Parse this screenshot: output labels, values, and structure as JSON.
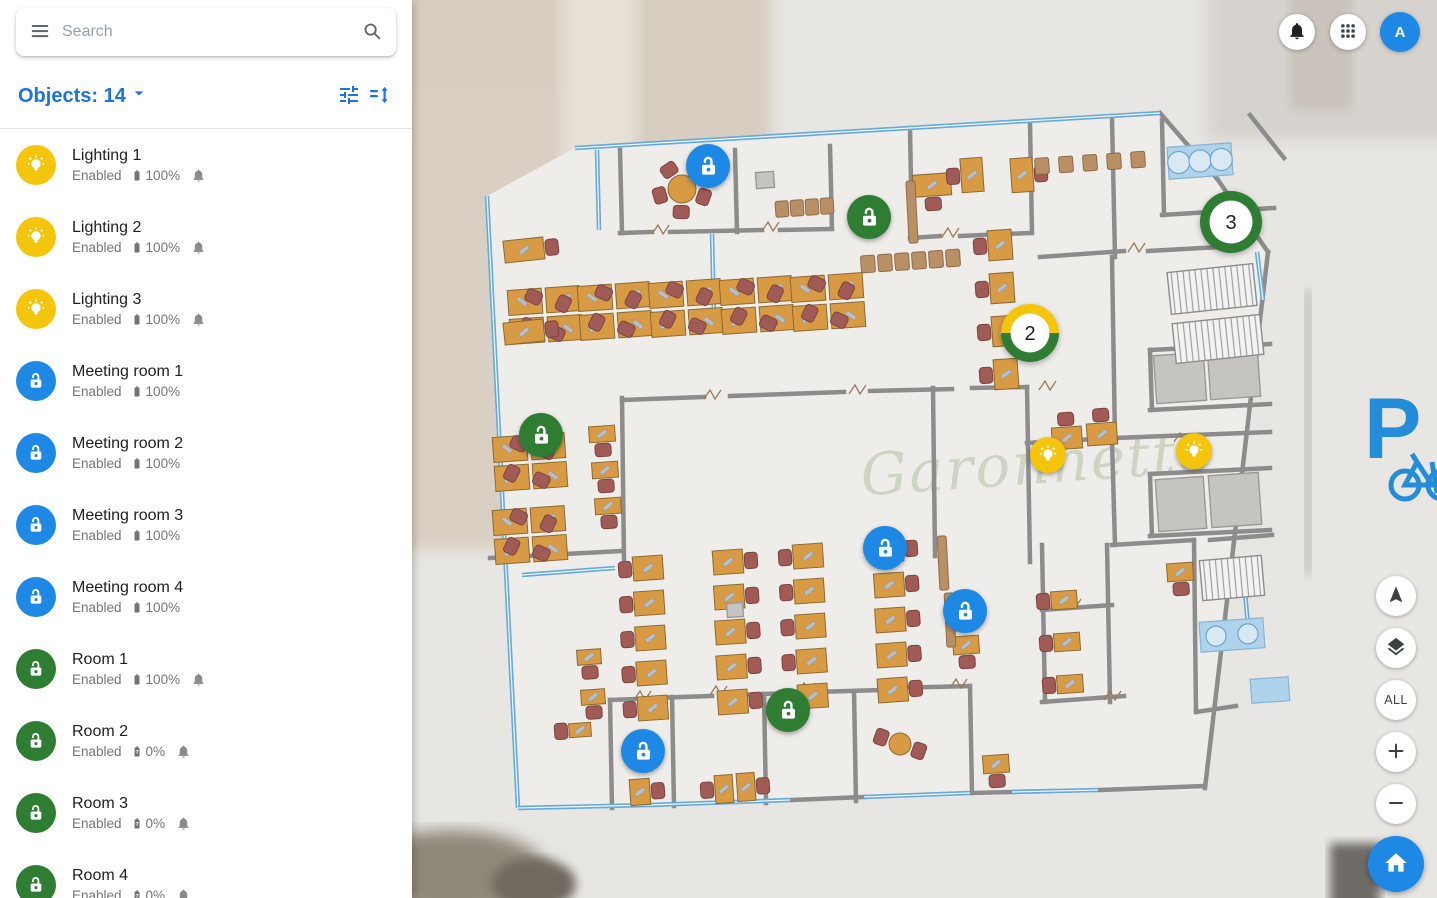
{
  "colors": {
    "accent_blue": "#1a73e8",
    "pin_blue": "#1E88E5",
    "pin_green": "#2E7D32",
    "pin_yellow": "#F4C50B",
    "status_gray": "#757575"
  },
  "sidebar": {
    "search": {
      "placeholder": "Search"
    },
    "header": {
      "text": "Objects: 14"
    },
    "items": [
      {
        "name": "Lighting 1",
        "status": "Enabled",
        "battery": "100%",
        "battery_state": "full",
        "bell": true,
        "icon": "bulb",
        "icon_color": "#F4C50B"
      },
      {
        "name": "Lighting 2",
        "status": "Enabled",
        "battery": "100%",
        "battery_state": "full",
        "bell": true,
        "icon": "bulb",
        "icon_color": "#F4C50B"
      },
      {
        "name": "Lighting 3",
        "status": "Enabled",
        "battery": "100%",
        "battery_state": "full",
        "bell": true,
        "icon": "bulb",
        "icon_color": "#F4C50B"
      },
      {
        "name": "Meeting room 1",
        "status": "Enabled",
        "battery": "100%",
        "battery_state": "full",
        "bell": false,
        "icon": "lock",
        "icon_color": "#1E88E5"
      },
      {
        "name": "Meeting room 2",
        "status": "Enabled",
        "battery": "100%",
        "battery_state": "full",
        "bell": false,
        "icon": "lock",
        "icon_color": "#1E88E5"
      },
      {
        "name": "Meeting room 3",
        "status": "Enabled",
        "battery": "100%",
        "battery_state": "full",
        "bell": false,
        "icon": "lock",
        "icon_color": "#1E88E5"
      },
      {
        "name": "Meeting room 4",
        "status": "Enabled",
        "battery": "100%",
        "battery_state": "full",
        "bell": false,
        "icon": "lock",
        "icon_color": "#1E88E5"
      },
      {
        "name": "Room 1",
        "status": "Enabled",
        "battery": "100%",
        "battery_state": "full",
        "bell": true,
        "icon": "lock",
        "icon_color": "#2E7D32"
      },
      {
        "name": "Room 2",
        "status": "Enabled",
        "battery": "0%",
        "battery_state": "unknown",
        "bell": true,
        "icon": "lock",
        "icon_color": "#2E7D32"
      },
      {
        "name": "Room 3",
        "status": "Enabled",
        "battery": "0%",
        "battery_state": "unknown",
        "bell": true,
        "icon": "lock",
        "icon_color": "#2E7D32"
      },
      {
        "name": "Room 4",
        "status": "Enabled",
        "battery": "0%",
        "battery_state": "unknown",
        "bell": true,
        "icon": "lock",
        "icon_color": "#2E7D32"
      }
    ]
  },
  "topbar": {
    "avatar_letter": "A"
  },
  "map": {
    "watermark": "Garonnette",
    "parking_label": "P",
    "markers": [
      {
        "type": "lock",
        "color": "blue",
        "x": 296,
        "y": 166
      },
      {
        "type": "lock",
        "color": "green",
        "x": 457,
        "y": 217
      },
      {
        "type": "cluster",
        "label": "3",
        "ring": "green",
        "x": 819,
        "y": 222
      },
      {
        "type": "cluster",
        "label": "2",
        "ring": "yellow-green",
        "x": 618,
        "y": 333
      },
      {
        "type": "lock",
        "color": "green",
        "x": 129,
        "y": 435
      },
      {
        "type": "bulb",
        "color": "yellow",
        "x": 636,
        "y": 455
      },
      {
        "type": "bulb",
        "color": "yellow",
        "x": 782,
        "y": 451
      },
      {
        "type": "lock",
        "color": "blue",
        "x": 473,
        "y": 548
      },
      {
        "type": "lock",
        "color": "blue",
        "x": 553,
        "y": 611
      },
      {
        "type": "lock",
        "color": "green",
        "x": 376,
        "y": 710
      },
      {
        "type": "lock",
        "color": "blue",
        "x": 231,
        "y": 751
      }
    ]
  },
  "controls": {
    "all_label": "ALL",
    "zoom_in": "+",
    "zoom_out": "−"
  }
}
